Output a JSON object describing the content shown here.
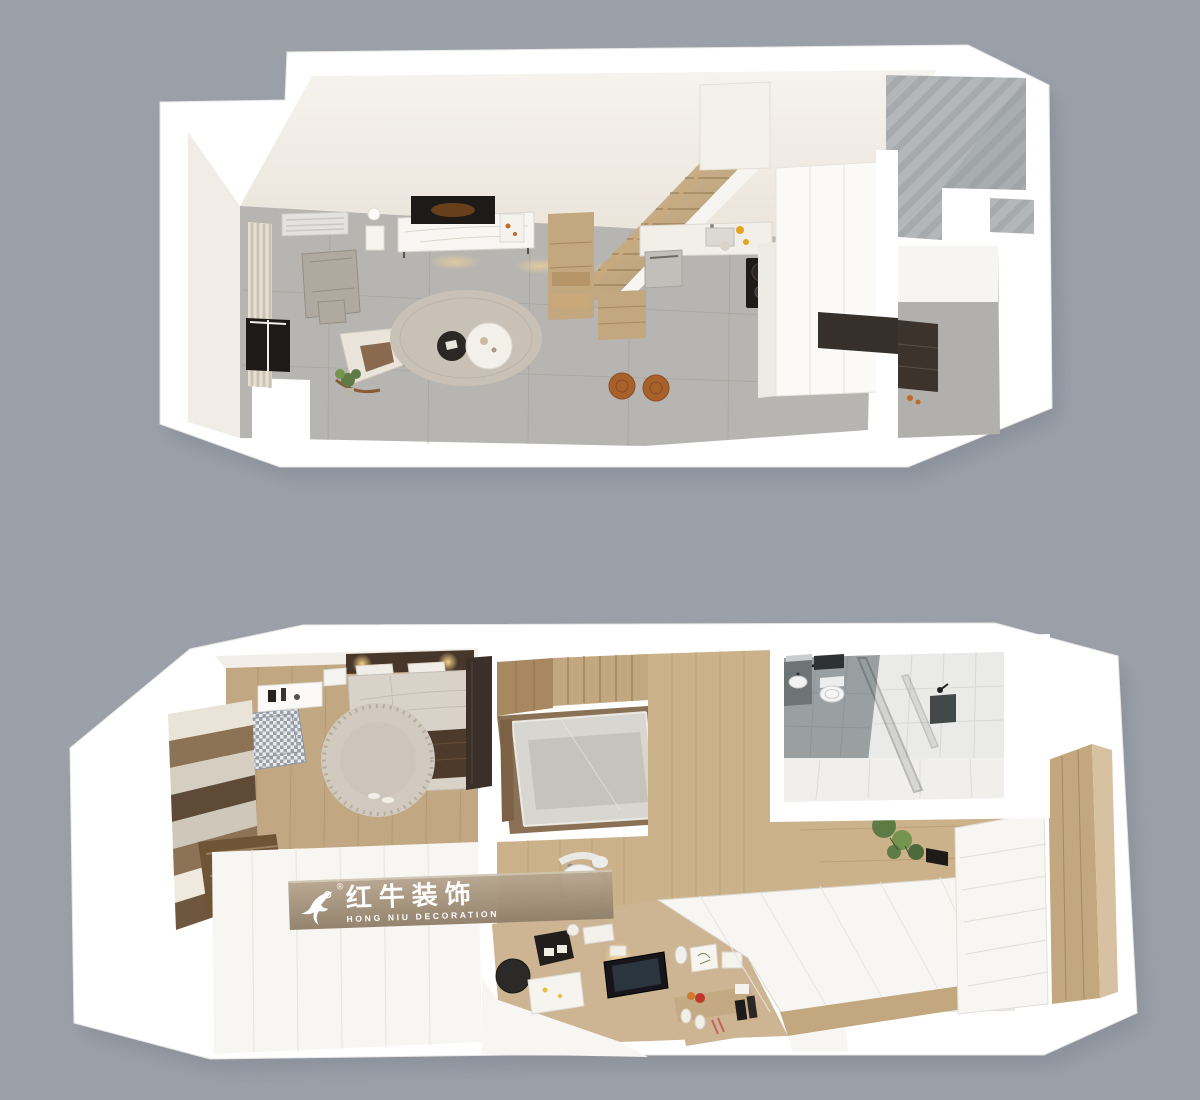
{
  "canvas": {
    "width": 1200,
    "height": 1100
  },
  "watermark": {
    "brand_cn": "红牛装饰",
    "brand_en": "HONG NIU DECORATION",
    "registered_mark": "®",
    "logo_icon": "horse-swoosh-icon"
  },
  "plans": [
    {
      "id": "upper-floor-plan",
      "rooms": [
        "living-room",
        "kitchen",
        "staircase",
        "concrete-shaft",
        "entry"
      ]
    },
    {
      "id": "loft-floor-plan",
      "rooms": [
        "bedroom",
        "stairwell",
        "study-desk-area",
        "bathroom",
        "wardrobe-corridor",
        "tatami-platform"
      ]
    }
  ],
  "palette": {
    "bg": "#9ba0a9",
    "wall": "#ffffff",
    "cream": "#f3efe8",
    "cream_light": "#f1ede6",
    "tile": "#b7b5b1",
    "tile_line": "#a39f9a",
    "concrete": "#b3b7b9",
    "concrete_dark": "#969b9d",
    "wood_light": "#d7c1a0",
    "wood_mid": "#c2a77f",
    "wood_deep": "#a8885f",
    "wood_dark": "#7c6144",
    "wood_floor": "#c2a882",
    "wood_floor_2": "#cbb28b",
    "panel_tan": "#cdb493",
    "cabinet_dark": "#362f2a",
    "near_black": "#1d1a18",
    "platform": "#f7f6f2",
    "bed": "#d9d2c9",
    "blanket": "#4e3a2b",
    "rug_living": "#c9c1b5",
    "rug_bedroom": "#d2cabf",
    "sofa": "#b0a9a0",
    "houndstooth_a": "#9aa0ab",
    "houndstooth_b": "#e8eaee",
    "bath_gray_tile": "#9aa0a2",
    "bath_white_tile": "#eaeae8",
    "stool_orange": "#a9612c",
    "plant_green": "#5e7b46",
    "plant_green_light": "#75944f",
    "warm_glow": "#ffd98f",
    "shadow": "#767b86",
    "band": "#a5937c",
    "watermark_text": "#ffffff"
  }
}
